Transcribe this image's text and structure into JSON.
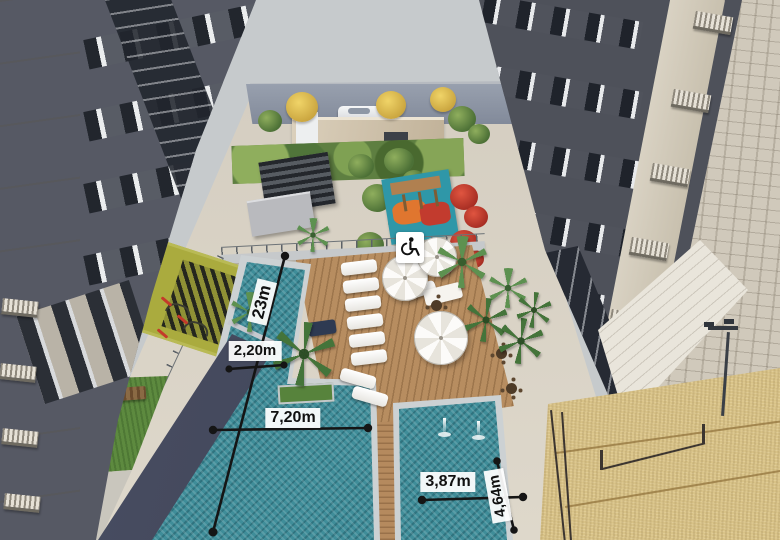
{
  "scene": {
    "type": "architectural-aerial-render",
    "subject": "Residential towers with courtyard leisure area: lap pool, main pool, kids pool with fountains, wood deck with loungers and umbrellas, pergola gourmet space, playground, bike area, lawn and beach-tennis sand court",
    "measurements": [
      {
        "id": "pool-total-length",
        "label": "23m",
        "orientation": "diagonal-vertical"
      },
      {
        "id": "lap-lane-width",
        "label": "2,20m",
        "orientation": "horizontal"
      },
      {
        "id": "main-pool-width",
        "label": "7,20m",
        "orientation": "horizontal"
      },
      {
        "id": "small-pool-width",
        "label": "3,87m",
        "orientation": "horizontal"
      },
      {
        "id": "small-pool-length",
        "label": "4,64m",
        "orientation": "diagonal-vertical"
      }
    ],
    "icons": [
      {
        "name": "wheelchair-accessibility-icon",
        "meaning": "accessible area"
      }
    ],
    "colors": {
      "sky": "#c6cacc",
      "pool_water": "#3f8d99",
      "deck_wood": "#b78d60",
      "sand": "#d8c287",
      "lawn": "#5d8a3f",
      "facade_dark": "#50535c",
      "facade_beige": "#d6d0c4",
      "bike_floor": "#aaab3e",
      "playground_teal": "#2f97a8",
      "flower_red": "#c0392e",
      "tree_yellow": "#e8c95c",
      "annotation_line": "#151515",
      "annotation_box": "#ffffff"
    }
  }
}
